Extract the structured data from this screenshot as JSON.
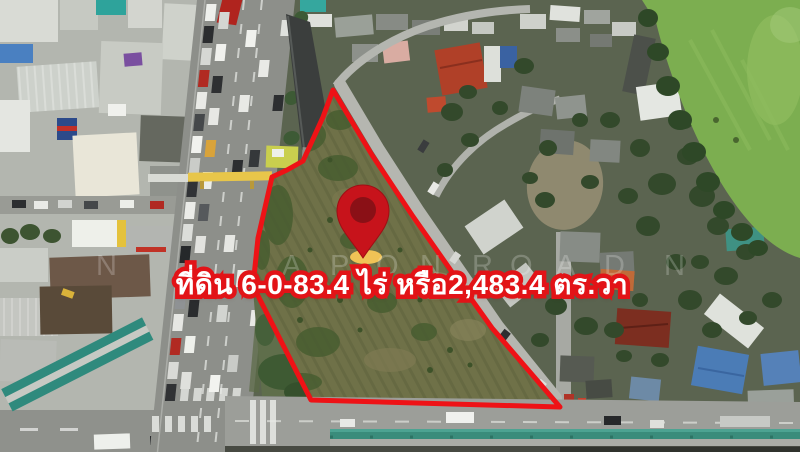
{
  "overlay": {
    "land_area_label": "ที่ดิน 6-0-83.4 ไร่ หรือ2,483.4 ตร.วา"
  },
  "watermark": {
    "letters": [
      "N",
      "A",
      "P",
      "O",
      "N",
      "R",
      "O",
      "A",
      "D",
      "N"
    ],
    "x_positions": [
      96,
      282,
      330,
      376,
      420,
      472,
      510,
      556,
      604,
      664
    ]
  },
  "colors": {
    "boundary_red": "#ee1216",
    "label_fill": "#ffffff",
    "label_outline": "#e21317",
    "pin_red": "#c7131b",
    "pin_inner_dark": "#8a1016",
    "pin_base_yellow": "#f0c356",
    "field_green": "#7cae50",
    "plot_olive": "#6f7148"
  },
  "icons": {
    "location_pin": "map-pin-icon"
  }
}
